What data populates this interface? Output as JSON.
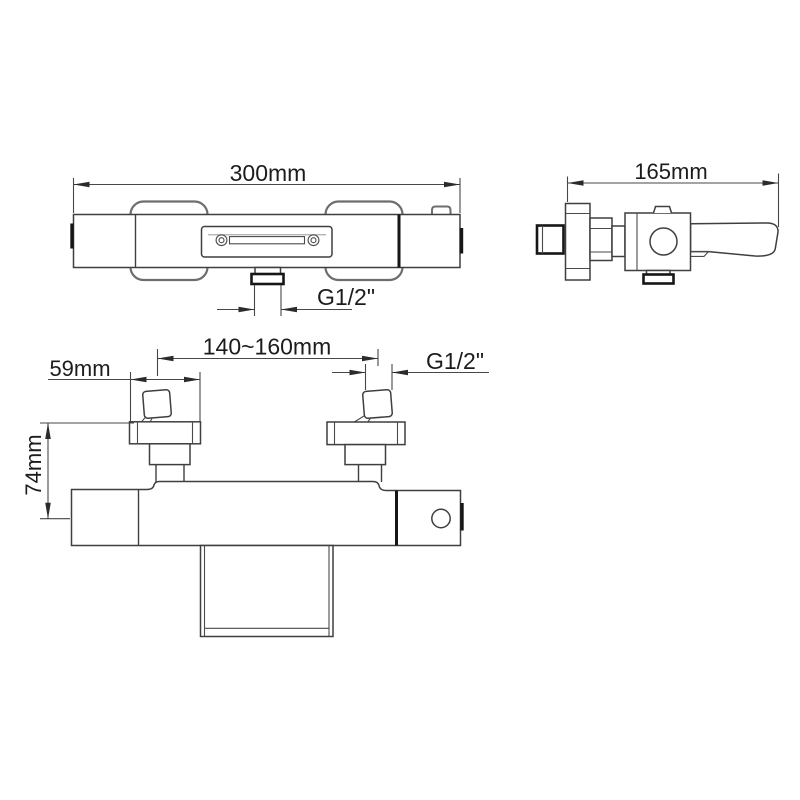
{
  "drawing": {
    "background_color": "#ffffff",
    "line_color": "#3f3f3f",
    "bold_line_color": "#161616",
    "labels": {
      "front_width": "300mm",
      "front_outlet_thread": "G1/2\"",
      "side_depth": "165mm",
      "inlet_spacing": "140~160mm",
      "escutcheon_width": "59mm",
      "inlet_thread": "G1/2\"",
      "mount_height": "74mm"
    }
  }
}
